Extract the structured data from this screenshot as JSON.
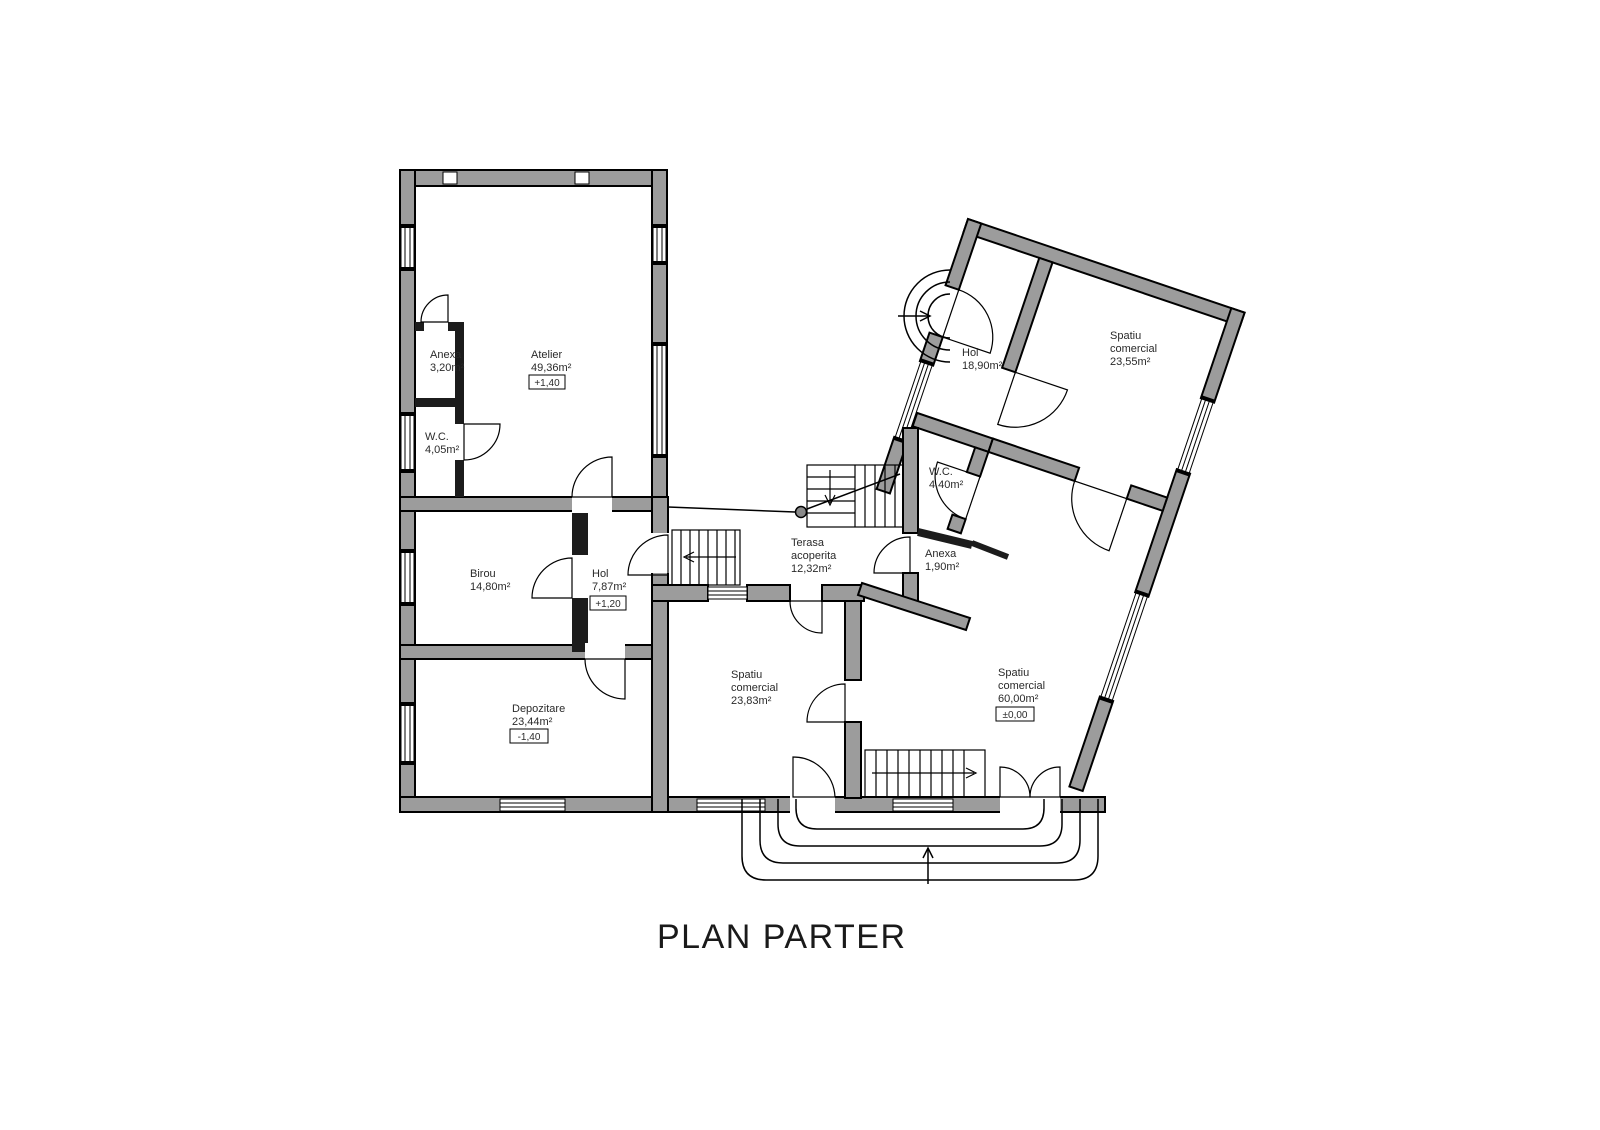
{
  "title": "PLAN PARTER",
  "colors": {
    "wall_fill": "#9c9c9c",
    "partition_fill": "#1c1c1c",
    "line": "#000000",
    "background": "#ffffff",
    "text": "#2a2a2a"
  },
  "rooms": {
    "anexa_left": {
      "name": "Anexa",
      "area": "3,20m²"
    },
    "atelier": {
      "name": "Atelier",
      "area": "49,36m²",
      "elevation": "+1,40"
    },
    "wc_left": {
      "name": "W.C.",
      "area": "4,05m²"
    },
    "birou": {
      "name": "Birou",
      "area": "14,80m²"
    },
    "hol_left": {
      "name": "Hol",
      "area": "7,87m²",
      "elevation": "+1,20"
    },
    "depozitare": {
      "name": "Depozitare",
      "area": "23,44m²",
      "elevation": "-1,40"
    },
    "terasa": {
      "name_line1": "Terasa",
      "name_line2": "acoperita",
      "area": "12,32m²"
    },
    "hol_right": {
      "name": "Hol",
      "area": "18,90m²"
    },
    "spatiu_comercial_1": {
      "name_line1": "Spatiu",
      "name_line2": "comercial",
      "area": "23,55m²"
    },
    "wc_right": {
      "name": "W.C.",
      "area": "4,40m²"
    },
    "anexa_right": {
      "name": "Anexa",
      "area": "1,90m²"
    },
    "spatiu_comercial_2": {
      "name_line1": "Spatiu",
      "name_line2": "comercial",
      "area": "23,83m²"
    },
    "spatiu_comercial_3": {
      "name_line1": "Spatiu",
      "name_line2": "comercial",
      "area": "60,00m²",
      "elevation": "±0,00"
    }
  }
}
